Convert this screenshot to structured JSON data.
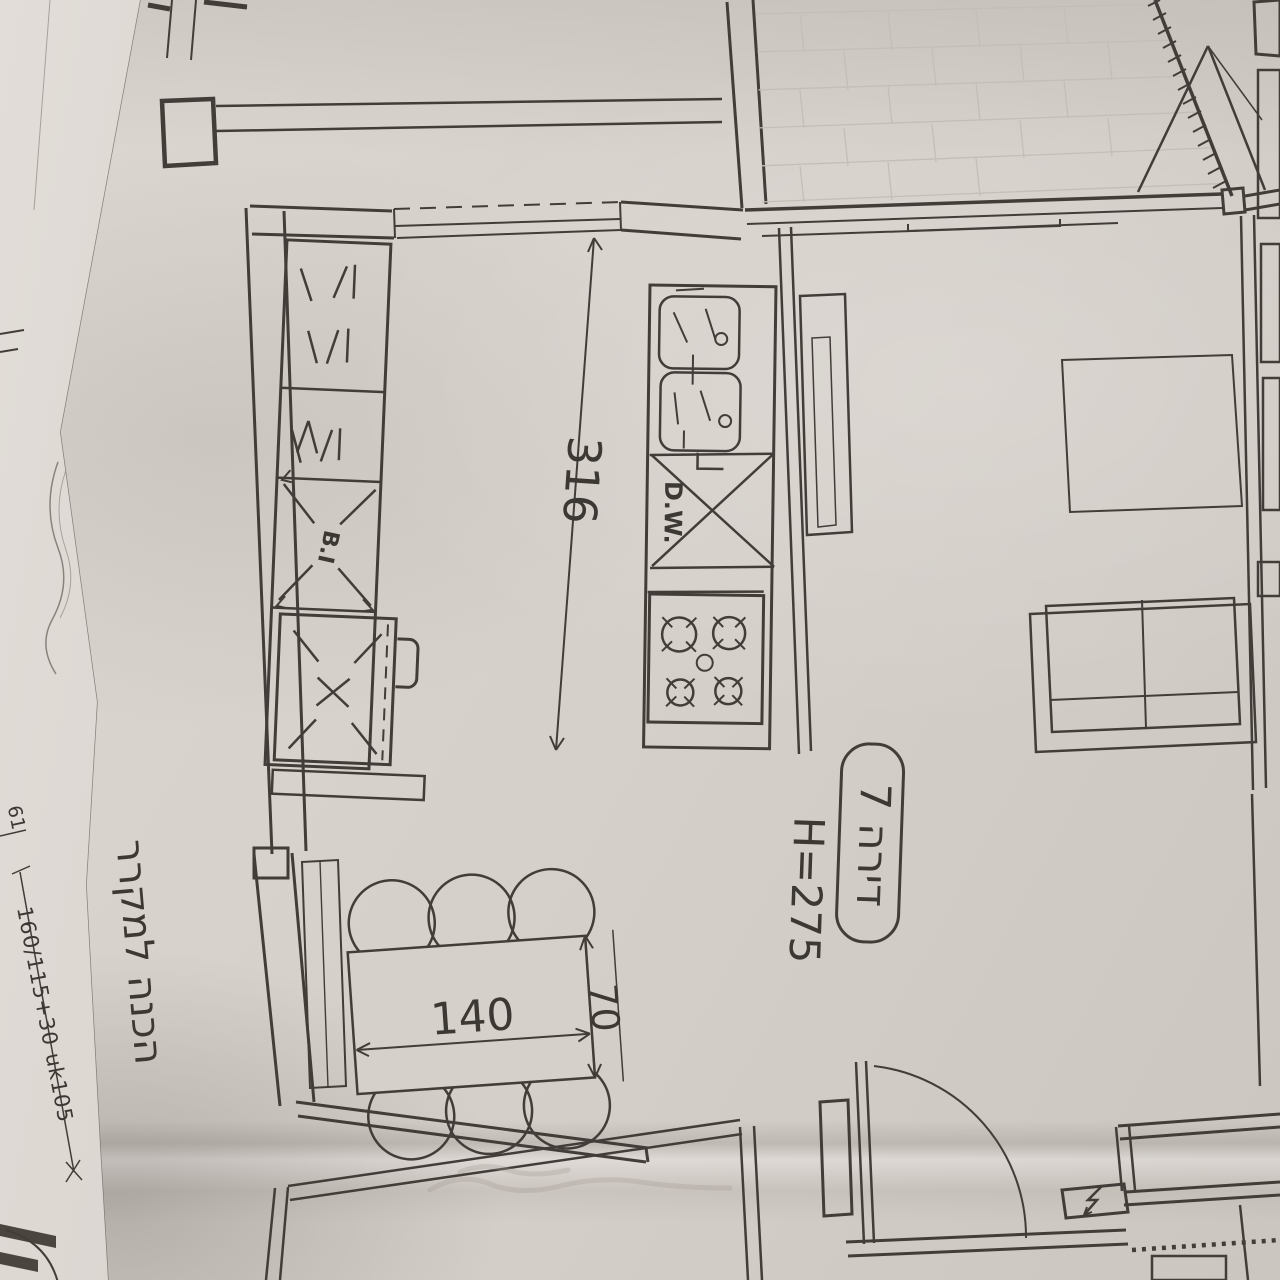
{
  "plan": {
    "unit_badge": "דירה 7",
    "height_note": "H=275",
    "kitchen_dim": "316",
    "table_length": "140",
    "table_depth": "70",
    "fridge_prep_note": "הכנה למקרר",
    "dishwasher_label": "D.W.",
    "built_in_label": "B.I",
    "window_spec": "160/115+30 uk105",
    "margin_number": "61"
  },
  "colors": {
    "paper": "#d8d2cb",
    "ink": "#423d38",
    "tile_line": "#c5beb6",
    "underlay": "#d7d2cd"
  }
}
